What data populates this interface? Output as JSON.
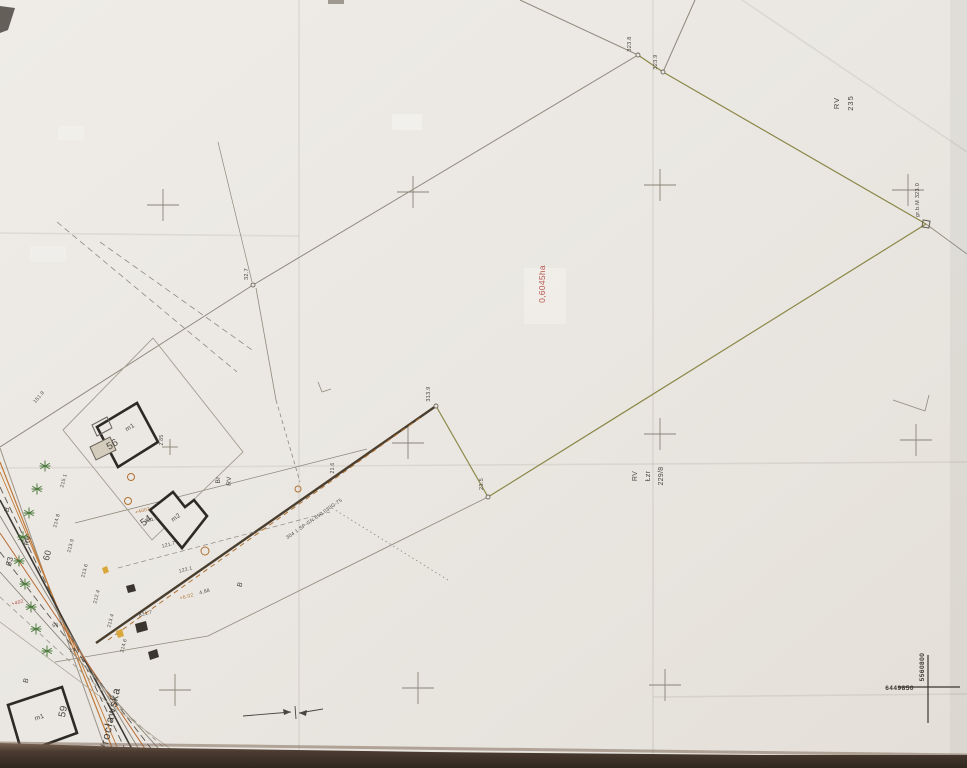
{
  "document": {
    "kind_note": "scanned cadastral survey map sheet",
    "parcel_area_label": "0,6045ha",
    "parcel_number": "229/8",
    "street_name": "Wrocławska"
  },
  "colors": {
    "paper": "#eae7e2",
    "paper_light": "#efece8",
    "paper_dark": "#e4dfd8",
    "line_gray": "#8f897d",
    "parcel_olive": "#8a8746",
    "boundary_dark": "#4a3e2e",
    "utility_orange": "#b07030",
    "utility_orange2": "#b96a33",
    "accent_red": "#b5554a",
    "building": "#2d2a26",
    "tree_green": "#4c7a3d",
    "cross_gray": "#8a8478",
    "label": "#4a463f",
    "edge_brown_dark": "#302720",
    "edge_brown_light": "#7a6352"
  },
  "map": {
    "labels": [
      {
        "n": "landuse-rv-235",
        "t": "RV",
        "x": 839,
        "y": 103,
        "r": -90,
        "s": 7.5,
        "ls": 1
      },
      {
        "n": "plot-number-235",
        "t": "235",
        "x": 853,
        "y": 103,
        "r": -90,
        "s": 7.5,
        "ls": 1
      },
      {
        "n": "parcel-area-label",
        "t": "0,6045ha",
        "x": 545,
        "y": 284,
        "r": -90,
        "s": 8.5,
        "c": "#b5554a"
      },
      {
        "n": "landuse-rv-229",
        "t": "RV",
        "x": 637,
        "y": 476,
        "r": -90,
        "s": 7
      },
      {
        "n": "landuse-lzr-229",
        "t": "Łzr",
        "x": 650,
        "y": 476,
        "r": -90,
        "s": 7
      },
      {
        "n": "plot-number-229-8",
        "t": "229/8",
        "x": 663,
        "y": 476,
        "r": -90,
        "s": 7
      },
      {
        "n": "point-elev-1",
        "t": "323.8",
        "x": 631,
        "y": 44,
        "r": -90,
        "s": 5.5
      },
      {
        "n": "point-elev-2",
        "t": "323.9",
        "x": 657,
        "y": 62,
        "r": -90,
        "s": 5.5
      },
      {
        "n": "point-elev-3",
        "t": "32.7",
        "x": 248,
        "y": 274,
        "r": -90,
        "s": 5.5
      },
      {
        "n": "point-elev-4",
        "t": "313.9",
        "x": 430,
        "y": 394,
        "r": -90,
        "s": 5.5
      },
      {
        "n": "point-elev-5",
        "t": "23.5",
        "x": 483,
        "y": 484,
        "r": -90,
        "s": 5.5
      },
      {
        "n": "boundary-note",
        "t": "gr.b.M 323.0",
        "x": 919,
        "y": 200,
        "r": -90,
        "s": 5.5
      },
      {
        "n": "landuse-br",
        "t": "Br",
        "x": 220,
        "y": 480,
        "r": -90,
        "s": 6.5
      },
      {
        "n": "landuse-rv-mid",
        "t": "RV",
        "x": 231,
        "y": 481,
        "r": -90,
        "s": 6.5
      },
      {
        "n": "street-name",
        "t": "Wrocławska",
        "x": 113,
        "y": 722,
        "r": -78,
        "s": 11,
        "c": "#3f3b35",
        "ls": 1
      },
      {
        "n": "building-56-number",
        "t": "56",
        "x": 114,
        "y": 447,
        "r": -32,
        "s": 10
      },
      {
        "n": "building-56-storeys",
        "t": "m1",
        "x": 131,
        "y": 429,
        "r": -32,
        "s": 6.5
      },
      {
        "n": "building-54-number",
        "t": "54",
        "x": 148,
        "y": 523,
        "r": -37,
        "s": 10
      },
      {
        "n": "building-54-storeys",
        "t": "m2",
        "x": 177,
        "y": 519,
        "r": -37,
        "s": 6.5
      },
      {
        "n": "building-59-number",
        "t": "59",
        "x": 66,
        "y": 712,
        "r": -78,
        "s": 10
      },
      {
        "n": "building-59-storeys",
        "t": "m1",
        "x": 40,
        "y": 719,
        "r": -20,
        "s": 6.5
      },
      {
        "n": "plot-number-60",
        "t": "60",
        "x": 50,
        "y": 556,
        "r": -75,
        "s": 9
      },
      {
        "n": "plot-number-63",
        "t": "63",
        "x": 12,
        "y": 562,
        "r": -75,
        "s": 8
      },
      {
        "n": "landuse-rv-street",
        "t": "RV",
        "x": 30,
        "y": 541,
        "r": -75,
        "s": 7
      },
      {
        "n": "landuse-b-1",
        "t": "B",
        "x": 9,
        "y": 510,
        "r": -75,
        "s": 7
      },
      {
        "n": "landuse-b-2",
        "t": "B",
        "x": 28,
        "y": 681,
        "r": -75,
        "s": 7
      },
      {
        "n": "landuse-b-3",
        "t": "B",
        "x": 242,
        "y": 585,
        "r": -75,
        "s": 7
      },
      {
        "t": "215.1",
        "x": 65,
        "y": 481,
        "r": -75,
        "s": 5
      },
      {
        "t": "214.8",
        "x": 58,
        "y": 521,
        "r": -75,
        "s": 5
      },
      {
        "t": "213.9",
        "x": 72,
        "y": 546,
        "r": -75,
        "s": 5
      },
      {
        "t": "213.6",
        "x": 86,
        "y": 571,
        "r": -75,
        "s": 5
      },
      {
        "t": "212.4",
        "x": 98,
        "y": 597,
        "r": -75,
        "s": 5
      },
      {
        "t": "213.4",
        "x": 112,
        "y": 621,
        "r": -75,
        "s": 5
      },
      {
        "t": "214.6",
        "x": 125,
        "y": 646,
        "r": -75,
        "s": 5
      },
      {
        "t": "121.8",
        "x": 152,
        "y": 521,
        "r": -15,
        "s": 5
      },
      {
        "t": "121.7",
        "x": 169,
        "y": 546,
        "r": -15,
        "s": 5
      },
      {
        "t": "122.1",
        "x": 186,
        "y": 571,
        "r": -15,
        "s": 5
      },
      {
        "t": "4.88",
        "x": 205,
        "y": 593,
        "r": -15,
        "s": 5
      },
      {
        "t": "+4002",
        "x": 143,
        "y": 512,
        "r": -15,
        "s": 5,
        "c": "#b07030"
      },
      {
        "t": "+6.02",
        "x": 187,
        "y": 598,
        "r": -15,
        "s": 5,
        "c": "#b07030"
      },
      {
        "t": "+402",
        "x": 18,
        "y": 604,
        "r": -15,
        "s": 5,
        "c": "#b0493f"
      },
      {
        "t": "53.1",
        "x": 58,
        "y": 626,
        "r": -15,
        "s": 5
      },
      {
        "t": "23.1",
        "x": 75,
        "y": 651,
        "r": -15,
        "s": 5
      },
      {
        "t": "821.7",
        "x": 146,
        "y": 615,
        "r": -15,
        "s": 5
      },
      {
        "t": "151.9",
        "x": 40,
        "y": 398,
        "r": -50,
        "s": 5
      },
      {
        "t": "21.6",
        "x": 334,
        "y": 468,
        "r": -90,
        "s": 5
      },
      {
        "t": "2.85",
        "x": 163,
        "y": 440,
        "r": -90,
        "s": 5
      },
      {
        "n": "utility-cable-note",
        "t": "304 1 SP-GN.650.030G-75",
        "x": 315,
        "y": 520,
        "r": -35,
        "s": 5
      }
    ],
    "lines": [
      {
        "x1": 520,
        "y1": 0,
        "x2": 638,
        "y2": 55,
        "c": "#8f897d",
        "w": 1
      },
      {
        "x1": 695,
        "y1": 0,
        "x2": 663,
        "y2": 72,
        "c": "#8f897d",
        "w": 1
      },
      {
        "x1": 638,
        "y1": 55,
        "x2": 253,
        "y2": 285,
        "c": "#8f897d",
        "w": 1
      },
      {
        "x1": 253,
        "y1": 285,
        "x2": 0,
        "y2": 447,
        "c": "#8f897d",
        "w": 1
      },
      {
        "x1": 218,
        "y1": 142,
        "x2": 252,
        "y2": 282,
        "c": "#8f897d",
        "w": 0.7
      },
      {
        "x1": 926,
        "y1": 224,
        "x2": 967,
        "y2": 254,
        "c": "#8f897d",
        "w": 0.9
      },
      {
        "x1": 488,
        "y1": 497,
        "x2": 208,
        "y2": 636,
        "c": "#8f897d",
        "w": 0.8
      },
      {
        "x1": 256,
        "y1": 288,
        "x2": 276,
        "y2": 400,
        "c": "#8f897d",
        "w": 0.8
      },
      {
        "x1": 276,
        "y1": 400,
        "x2": 300,
        "y2": 482,
        "c": "#8f897d",
        "w": 0.8,
        "d": "4 3"
      },
      {
        "x1": 638,
        "y1": 55,
        "x2": 663,
        "y2": 72,
        "c": "#8a8746",
        "w": 1.2
      },
      {
        "x1": 663,
        "y1": 72,
        "x2": 926,
        "y2": 224,
        "c": "#8a8746",
        "w": 1.2
      },
      {
        "x1": 926,
        "y1": 224,
        "x2": 488,
        "y2": 497,
        "c": "#8a8746",
        "w": 1.2
      },
      {
        "x1": 488,
        "y1": 497,
        "x2": 436,
        "y2": 406,
        "c": "#8a8746",
        "w": 1.2
      },
      {
        "x1": 436,
        "y1": 406,
        "x2": 96,
        "y2": 643,
        "c": "#4a3e2e",
        "w": 2.4
      },
      {
        "x1": 420,
        "y1": 418,
        "x2": 108,
        "y2": 640,
        "c": "#b07030",
        "w": 1,
        "d": "5 4"
      },
      {
        "x1": 75,
        "y1": 523,
        "x2": 367,
        "y2": 449,
        "c": "#8f897d",
        "w": 0.8
      },
      {
        "x1": 118,
        "y1": 568,
        "x2": 330,
        "y2": 512,
        "c": "#8f897d",
        "w": 0.7,
        "d": "5 3"
      },
      {
        "x1": 55,
        "y1": 662,
        "x2": 208,
        "y2": 636,
        "c": "#8f897d",
        "w": 0.8
      },
      {
        "x1": 332,
        "y1": 508,
        "x2": 448,
        "y2": 580,
        "c": "#8f897d",
        "w": 0.8,
        "d": "1.5 3"
      },
      {
        "x1": 57,
        "y1": 222,
        "x2": 237,
        "y2": 372,
        "c": "#8f897d",
        "w": 0.8,
        "d": "6 4"
      },
      {
        "x1": 100,
        "y1": 242,
        "x2": 255,
        "y2": 352,
        "c": "#8f897d",
        "w": 0.8,
        "d": "6 4"
      },
      {
        "x1": 893,
        "y1": 400,
        "x2": 925,
        "y2": 411,
        "c": "#8f897d",
        "w": 0.8
      },
      {
        "x1": 925,
        "y1": 411,
        "x2": 929,
        "y2": 395,
        "c": "#8f897d",
        "w": 0.8
      },
      {
        "x1": 0,
        "y1": 448,
        "x2": 112,
        "y2": 768,
        "c": "#9a9488",
        "w": 1
      },
      {
        "x1": 0,
        "y1": 462,
        "x2": 120,
        "y2": 768,
        "c": "#c07a38",
        "w": 1.2
      },
      {
        "x1": 0,
        "y1": 472,
        "x2": 126,
        "y2": 768,
        "c": "#c07a38",
        "w": 0.9
      },
      {
        "x1": 0,
        "y1": 487,
        "x2": 134,
        "y2": 768,
        "c": "#5b564e",
        "w": 0.9,
        "d": "7 4"
      },
      {
        "x1": 0,
        "y1": 500,
        "x2": 142,
        "y2": 768,
        "c": "#3c3832",
        "w": 1.6
      },
      {
        "x1": 0,
        "y1": 516,
        "x2": 150,
        "y2": 768,
        "c": "#8a8478",
        "w": 0.9
      },
      {
        "x1": 0,
        "y1": 533,
        "x2": 158,
        "y2": 768,
        "c": "#b96a33",
        "w": 1
      },
      {
        "x1": 0,
        "y1": 552,
        "x2": 166,
        "y2": 768,
        "c": "#5b564e",
        "w": 0.9,
        "d": "7 4"
      },
      {
        "x1": 0,
        "y1": 572,
        "x2": 176,
        "y2": 768,
        "c": "#8a8478",
        "w": 0.9
      },
      {
        "x1": 0,
        "y1": 597,
        "x2": 186,
        "y2": 768,
        "c": "#9a9488",
        "w": 0.8,
        "d": "5 4"
      },
      {
        "x1": 0,
        "y1": 622,
        "x2": 196,
        "y2": 768,
        "c": "#b0a89a",
        "w": 0.8
      },
      {
        "x1": 243,
        "y1": 716,
        "x2": 291,
        "y2": 712,
        "c": "#4a463f",
        "w": 0.9
      },
      {
        "x1": 299,
        "y1": 713,
        "x2": 323,
        "y2": 709,
        "c": "#4a463f",
        "w": 0.9
      },
      {
        "x1": 295,
        "y1": 706,
        "x2": 296,
        "y2": 719,
        "c": "#4a463f",
        "w": 0.9
      },
      {
        "x1": 318,
        "y1": 382,
        "x2": 322,
        "y2": 392,
        "c": "#8f897d",
        "w": 0.8
      },
      {
        "x1": 322,
        "y1": 392,
        "x2": 331,
        "y2": 389,
        "c": "#8f897d",
        "w": 0.8
      }
    ],
    "parcel_outlines": [
      {
        "pts": "63,430 153,338 243,452 152,540",
        "c": "#a39d90",
        "w": 0.9
      }
    ],
    "buildings": [
      {
        "n": "building-56",
        "pts": "97,427 137,403 158,442 118,467"
      },
      {
        "n": "building-54",
        "pts": "150,510 173,492 185,507 194,500 207,516 182,548"
      },
      {
        "n": "building-59",
        "pts": "8,705 62,687 77,733 22,753"
      }
    ],
    "small_polys": [
      {
        "pts": "92,425 107,417 112,428 97,436",
        "s": "#6a655a",
        "w": 1,
        "f": "none"
      },
      {
        "pts": "90,447 110,437 116,450 96,460",
        "s": "#6a655a",
        "w": 1,
        "f": "#d3ccbd"
      },
      {
        "pts": "135,624 146,621 148,630 137,633",
        "f": "#3a362f"
      },
      {
        "pts": "126,586 134,584 136,591 128,593",
        "f": "#3a362f"
      },
      {
        "pts": "148,652 157,649 159,657 150,660",
        "f": "#3a362f"
      },
      {
        "pts": "116,631 122,629 124,636 118,638",
        "f": "#d9a83c"
      },
      {
        "pts": "102,568 107,566 109,572 104,574",
        "f": "#d9a83c"
      },
      {
        "pts": "291,712 283,709 284,715",
        "f": "#4a463f"
      },
      {
        "pts": "299,713 307,710 306,716",
        "f": "#4a463f"
      }
    ],
    "survey_crosses": [
      {
        "x": 163,
        "y": 205
      },
      {
        "x": 413,
        "y": 192
      },
      {
        "x": 660,
        "y": 185
      },
      {
        "x": 908,
        "y": 190
      },
      {
        "x": 408,
        "y": 443
      },
      {
        "x": 660,
        "y": 434
      },
      {
        "x": 916,
        "y": 440
      },
      {
        "x": 175,
        "y": 690
      },
      {
        "x": 418,
        "y": 688
      },
      {
        "x": 665,
        "y": 685
      },
      {
        "x": 170,
        "y": 447,
        "a": 8
      }
    ],
    "coordinate_cross": {
      "x": 928,
      "y": 687,
      "h_label": "6449850",
      "v_label": "5560800"
    },
    "utility_circles": [
      {
        "x": 131,
        "y": 477,
        "r": 3.5
      },
      {
        "x": 128,
        "y": 501,
        "r": 3.5
      },
      {
        "x": 205,
        "y": 551,
        "r": 4
      },
      {
        "x": 298,
        "y": 489,
        "r": 3
      }
    ],
    "boundary_points": [
      [
        638,
        55
      ],
      [
        663,
        72
      ],
      [
        253,
        285
      ],
      [
        436,
        406
      ],
      [
        488,
        497
      ]
    ],
    "marker_square": {
      "x": 926,
      "y": 224
    },
    "trees": [
      [
        45,
        466
      ],
      [
        37,
        489
      ],
      [
        29,
        513
      ],
      [
        23,
        537
      ],
      [
        19,
        561
      ],
      [
        25,
        584
      ],
      [
        31,
        607
      ],
      [
        36,
        629
      ],
      [
        47,
        651
      ]
    ],
    "paper": {
      "patches": [
        {
          "x": 392,
          "y": 114,
          "w": 30,
          "h": 16,
          "o": 0.75
        },
        {
          "x": 58,
          "y": 126,
          "w": 26,
          "h": 14,
          "o": 0.6
        },
        {
          "x": 524,
          "y": 268,
          "w": 42,
          "h": 56,
          "o": 0.6
        },
        {
          "x": 30,
          "y": 246,
          "w": 36,
          "h": 16,
          "o": 0.5
        }
      ],
      "folds": [
        {
          "x1": 299,
          "y1": 0,
          "x2": 299,
          "y2": 768
        },
        {
          "x1": 653,
          "y1": 0,
          "x2": 653,
          "y2": 768
        },
        {
          "x1": 0,
          "y1": 233,
          "x2": 299,
          "y2": 236
        },
        {
          "x1": 0,
          "y1": 468,
          "x2": 967,
          "y2": 462
        },
        {
          "x1": 653,
          "y1": 697,
          "x2": 967,
          "y2": 694
        },
        {
          "x1": 742,
          "y1": 0,
          "x2": 967,
          "y2": 152
        }
      ]
    }
  }
}
